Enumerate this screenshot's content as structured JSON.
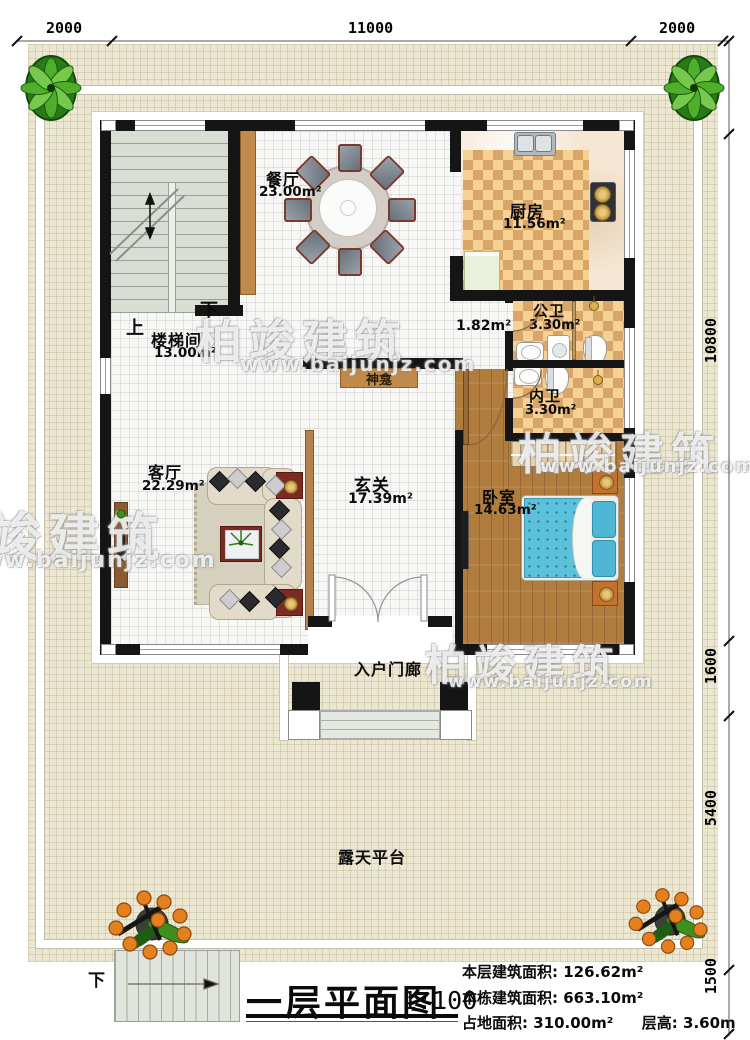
{
  "title_block": {
    "title": "一层平面图",
    "scale": "1:100",
    "stats": [
      {
        "label": "本层建筑面积:",
        "value": "126.62m²"
      },
      {
        "label": "本栋建筑面积:",
        "value": "663.10m²"
      },
      {
        "label": "占地面积:",
        "value": "310.00m²"
      },
      {
        "label": "层高:",
        "value": "3.60m"
      }
    ]
  },
  "watermark": {
    "brand": "柏竣建筑",
    "url": "www.baijunjz.com"
  },
  "dimensions": {
    "top": [
      "2000",
      "11000",
      "2000"
    ],
    "right": [
      "2000",
      "10800",
      "1600",
      "5400",
      "1500"
    ]
  },
  "rooms": {
    "dining": {
      "name": "餐厅",
      "area": "23.00m²"
    },
    "kitchen": {
      "name": "厨房",
      "area": "11.56m²"
    },
    "stairwell": {
      "name": "楼梯间",
      "area": "13.00m²"
    },
    "hallway": {
      "area": "1.82m²"
    },
    "public_bath": {
      "name": "公卫",
      "area": "3.30m²"
    },
    "private_bath": {
      "name": "内卫",
      "area": "3.30m²"
    },
    "shrine": {
      "name": "神龛"
    },
    "foyer": {
      "name": "玄关",
      "area": "17.39m²"
    },
    "living": {
      "name": "客厅",
      "area": "22.29m²"
    },
    "bedroom": {
      "name": "卧室",
      "area": "14.63m²"
    },
    "porch": {
      "name": "入户门廊"
    },
    "terrace": {
      "name": "露天平台"
    }
  },
  "stairs": {
    "up": "上",
    "down": "下",
    "outdoor_down": "下"
  },
  "colors": {
    "wall": "#151515",
    "terrace_floor": "#ece7d2",
    "checker_light": "#f6d193",
    "checker_dark": "#d9a66a",
    "wood_floor": "#b17d3f",
    "bed_blue": "#5cc2dc",
    "cabinet_brown": "#c08a4a",
    "stair_gray": "#d9ded4"
  }
}
